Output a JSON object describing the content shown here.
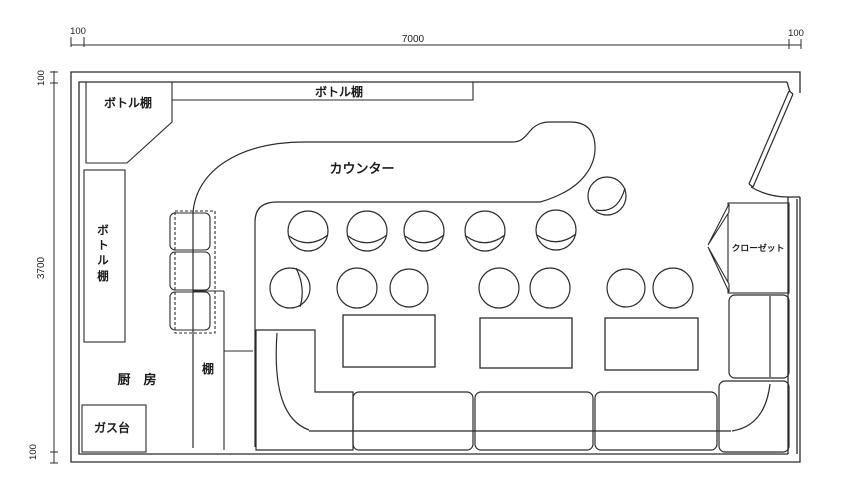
{
  "drawing": {
    "title": "bar floor plan",
    "labels": {
      "bottle_shelf_topleft": "ボトル棚",
      "bottle_shelf_top": "ボトル棚",
      "bottle_shelf_left": "ボトル棚",
      "counter": "カウンター",
      "closet": "クローゼット",
      "kitchen": "厨　房",
      "shelf": "棚",
      "gas_stove": "ガス台"
    },
    "dimensions": {
      "top": {
        "left_margin": "100",
        "span": "7000",
        "right_margin": "100"
      },
      "left": {
        "top_margin": "100",
        "span": "3700",
        "bottom_margin": "100"
      }
    },
    "colors": {
      "line": "#2b2b2b",
      "background": "#ffffff"
    }
  }
}
